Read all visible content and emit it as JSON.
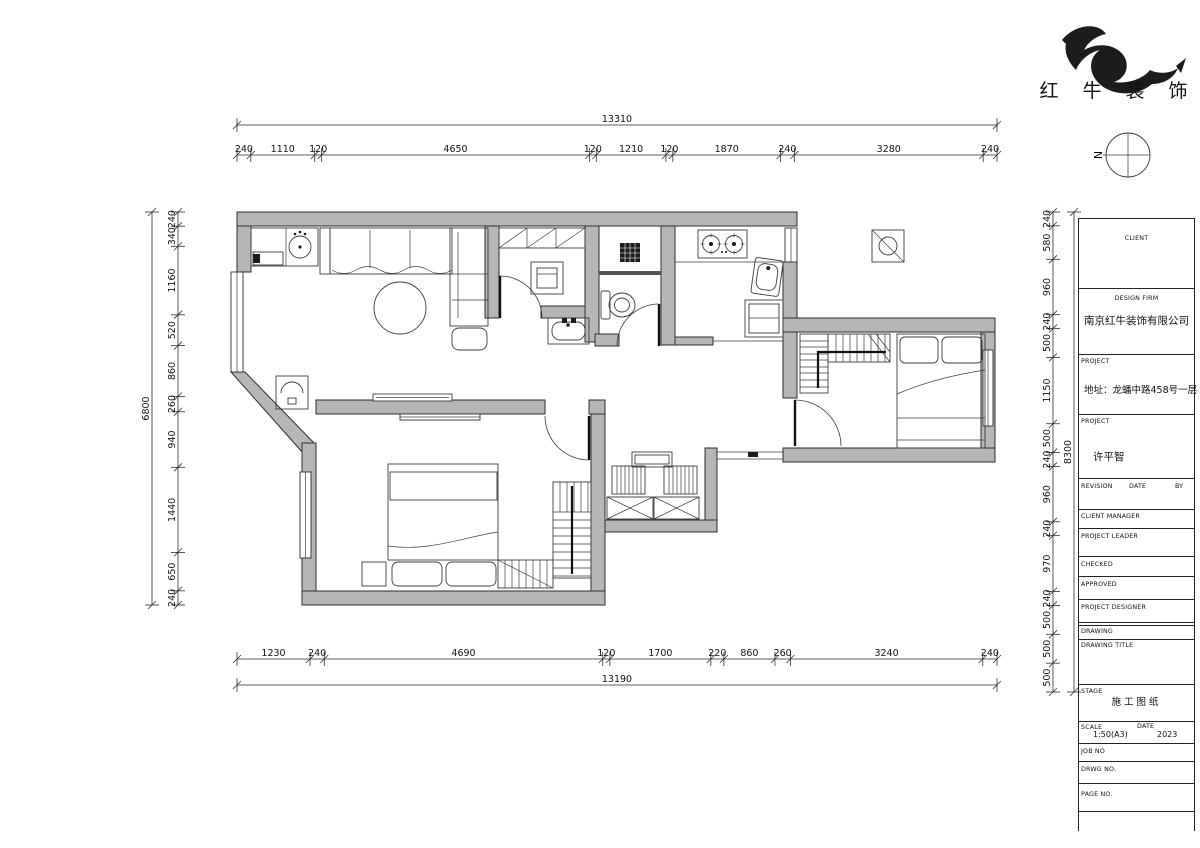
{
  "logo": {
    "text": "红 牛 装 饰"
  },
  "compass": {
    "label": "N"
  },
  "dimensions": {
    "top": {
      "overall": [
        "13310"
      ],
      "segments": [
        "240",
        "1110",
        "120",
        "4650",
        "120",
        "1210",
        "120",
        "1870",
        "240",
        "3280",
        "240"
      ]
    },
    "bottom": {
      "overall": [
        "13190"
      ],
      "segments": [
        "1230",
        "240",
        "4690",
        "120",
        "1700",
        "220",
        "860",
        "260",
        "3240",
        "240"
      ]
    },
    "left": {
      "overall": [
        "6800"
      ],
      "segments": [
        "240",
        "340",
        "1160",
        "520",
        "860",
        "260",
        "940",
        "1440",
        "650",
        "240"
      ]
    },
    "right": {
      "overall": [
        "8300"
      ],
      "segments": [
        "240",
        "580",
        "960",
        "240",
        "500",
        "1150",
        "500",
        "240",
        "960",
        "240",
        "970",
        "240",
        "500",
        "500",
        "500"
      ]
    }
  },
  "title_block": {
    "client_label": "CLIENT",
    "design_firm_label": "DESIGN FIRM",
    "design_firm": "南京红牛装饰有限公司",
    "project_label": "PROJECT",
    "address": "地址：龙蟠中路458号一层",
    "project_label2": "PROJECT",
    "project_name": "许平智",
    "revision_label": "REVISION",
    "date_label": "DATE",
    "by_label": "BY",
    "client_manager_label": "CLIENT MANAGER",
    "project_leader_label": "PROJECT LEADER",
    "checked_label": "CHECKED",
    "approved_label": "APPROVED",
    "project_designer_label": "PROJECT DESIGNER",
    "drawing_label": "DRAWING",
    "drawing_title_label": "DRAWING TITLE",
    "stage_label": "STAGE",
    "stage_value": "施工图纸",
    "scale_label": "SCALE",
    "scale_value": "1:50(A3)",
    "date_label2": "DATE",
    "date_value": "2023",
    "job_no_label": "JOB NO",
    "drwg_no_label": "DRWG NO.",
    "page_no_label": "PAGE NO."
  }
}
